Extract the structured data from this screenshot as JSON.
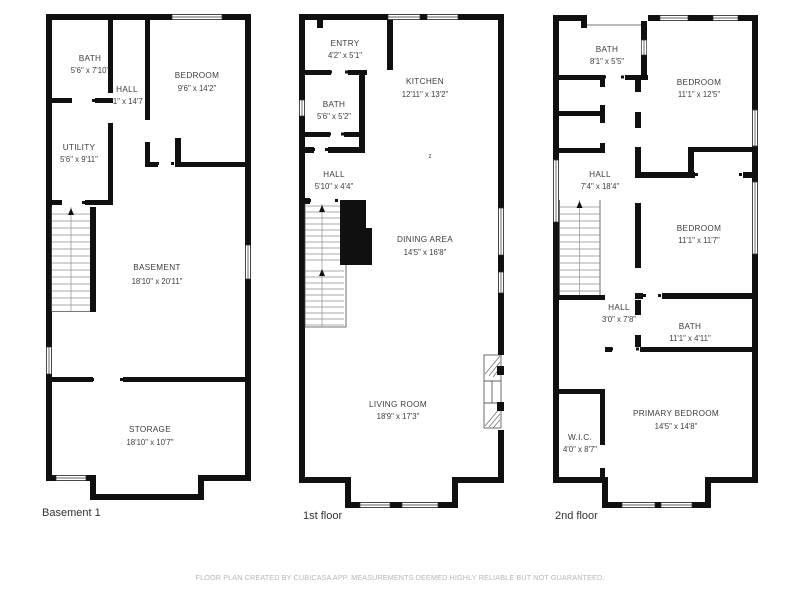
{
  "page": {
    "background": "#ffffff",
    "wall_color": "#101010",
    "footer": "FLOOR PLAN CREATED BY CUBICASA APP. MEASUREMENTS DEEMED HIGHLY RELIABLE BUT NOT GUARANTEED."
  },
  "floors": [
    {
      "label": "Basement 1",
      "rooms": [
        {
          "name": "BATH",
          "dims": "5'6\" x 7'10\""
        },
        {
          "name": "HALL",
          "dims": "'1\" x 14'7"
        },
        {
          "name": "BEDROOM",
          "dims": "9'6\" x 14'2\""
        },
        {
          "name": "UTILITY",
          "dims": "5'6\" x 9'11\""
        },
        {
          "name": "BASEMENT",
          "dims": "18'10\" x 20'11\""
        },
        {
          "name": "STORAGE",
          "dims": "18'10\" x 10'7\""
        }
      ]
    },
    {
      "label": "1st floor",
      "annotation": "z",
      "rooms": [
        {
          "name": "ENTRY",
          "dims": "4'2\" x 5'1\""
        },
        {
          "name": "BATH",
          "dims": "5'6\" x 5'2\""
        },
        {
          "name": "KITCHEN",
          "dims": "12'11\" x 13'2\""
        },
        {
          "name": "HALL",
          "dims": "5'10\" x 4'4\""
        },
        {
          "name": "DINING AREA",
          "dims": "14'5\" x 16'8\""
        },
        {
          "name": "LIVING ROOM",
          "dims": "18'9\" x 17'3\""
        }
      ]
    },
    {
      "label": "2nd floor",
      "rooms": [
        {
          "name": "BATH",
          "dims": "8'1\" x 5'5\""
        },
        {
          "name": "BEDROOM",
          "dims": "11'1\" x 12'5\""
        },
        {
          "name": "HALL",
          "dims": "7'4\" x 18'4\""
        },
        {
          "name": "BEDROOM",
          "dims": "11'1\" x 11'7\""
        },
        {
          "name": "HALL",
          "dims": "3'0\" x 7'8\""
        },
        {
          "name": "BATH",
          "dims": "11'1\" x 4'11\""
        },
        {
          "name": "W.I.C.",
          "dims": "4'0\" x 8'7\""
        },
        {
          "name": "PRIMARY BEDROOM",
          "dims": "14'5\" x 14'8\""
        }
      ]
    }
  ]
}
